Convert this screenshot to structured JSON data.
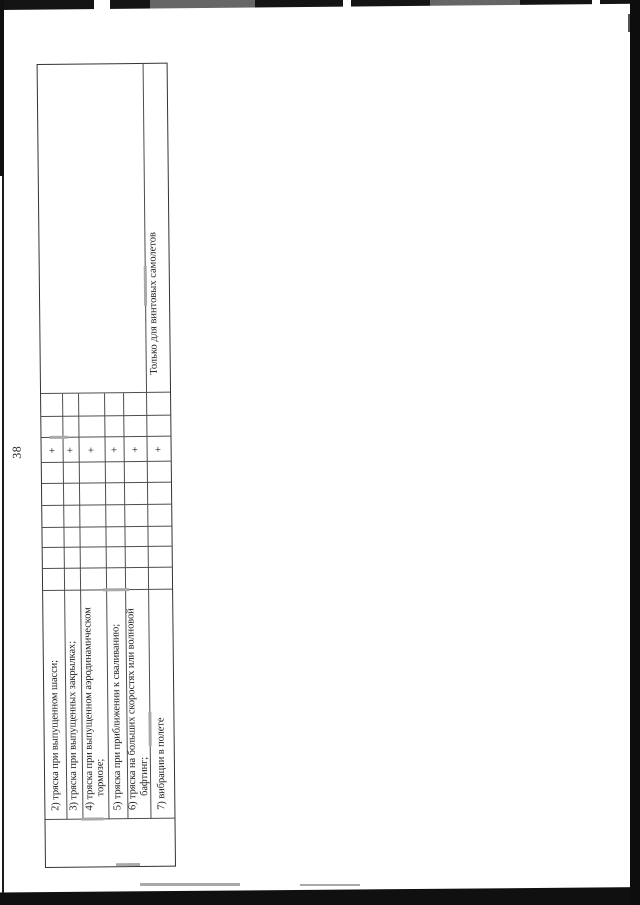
{
  "page": {
    "number": "38"
  },
  "table": {
    "ink_color": "#1d1d1d",
    "note_column_note": "Только для винтовых самолетов",
    "rows": [
      {
        "label": "2) тряска при выпущенном шасси;",
        "mark": "+",
        "note": ""
      },
      {
        "label": "3) тряска при выпущенных закрылках;",
        "mark": "+",
        "note": ""
      },
      {
        "label": "4) тряска при выпущенном аэродинамическом\nтормозе;",
        "mark": "+",
        "note": ""
      },
      {
        "label": "5) тряска при приближении к сваливанию;",
        "mark": "+",
        "note": ""
      },
      {
        "label": "6) тряска на больших скоростях или волновой\nбафтинг;",
        "mark": "+",
        "note": ""
      },
      {
        "label": "7) вибрации в полете",
        "mark": "+",
        "note": "Только для винтовых самолетов"
      }
    ]
  }
}
